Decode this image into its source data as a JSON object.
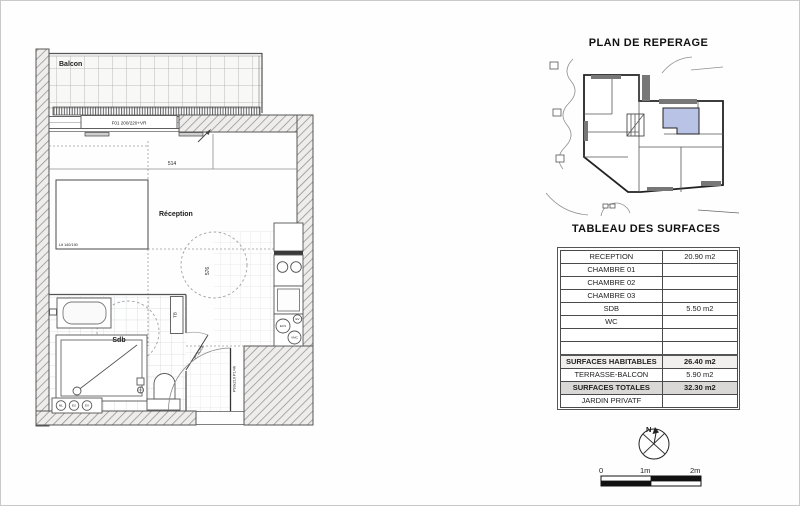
{
  "floor_plan": {
    "balcony_label": "Balcon",
    "window_label": "F01 200/220+VR",
    "width_dim": "514",
    "height_dim": "576",
    "reception_label": "Réception",
    "bed_label": "Lit 140/190",
    "bathroom_label": "Sdb",
    "towel_unit_label": "TB",
    "bathroom_door_label": "P73x204",
    "entry_door_label": "P93x210 P1/4h",
    "bath_utilities": [
      "ML",
      "EU",
      "EV"
    ],
    "kitchen_utilities": [
      "ECS",
      "EV",
      "VMC"
    ]
  },
  "location_plan": {
    "title": "PLAN DE REPERAGE",
    "highlight_color": "#b9c3e6"
  },
  "surface_table": {
    "title": "TABLEAU DES SURFACES",
    "rows": [
      {
        "label": "RECEPTION",
        "value": "20.90 m2"
      },
      {
        "label": "CHAMBRE 01",
        "value": ""
      },
      {
        "label": "CHAMBRE 02",
        "value": ""
      },
      {
        "label": "CHAMBRE 03",
        "value": ""
      },
      {
        "label": "SDB",
        "value": "5.50 m2"
      },
      {
        "label": "WC",
        "value": ""
      },
      {
        "label": "",
        "value": ""
      },
      {
        "label": "",
        "value": ""
      },
      {
        "label": "SURFACES HABITABLES",
        "value": "26.40 m2"
      },
      {
        "label": "TERRASSE-BALCON",
        "value": "5.90 m2"
      },
      {
        "label": "SURFACES TOTALES",
        "value": "32.30 m2"
      },
      {
        "label": "JARDIN PRIVATF",
        "value": ""
      }
    ]
  },
  "compass": {
    "north_label": "N"
  },
  "scale_bar": {
    "labels": [
      "0",
      "1m",
      "2m"
    ]
  }
}
